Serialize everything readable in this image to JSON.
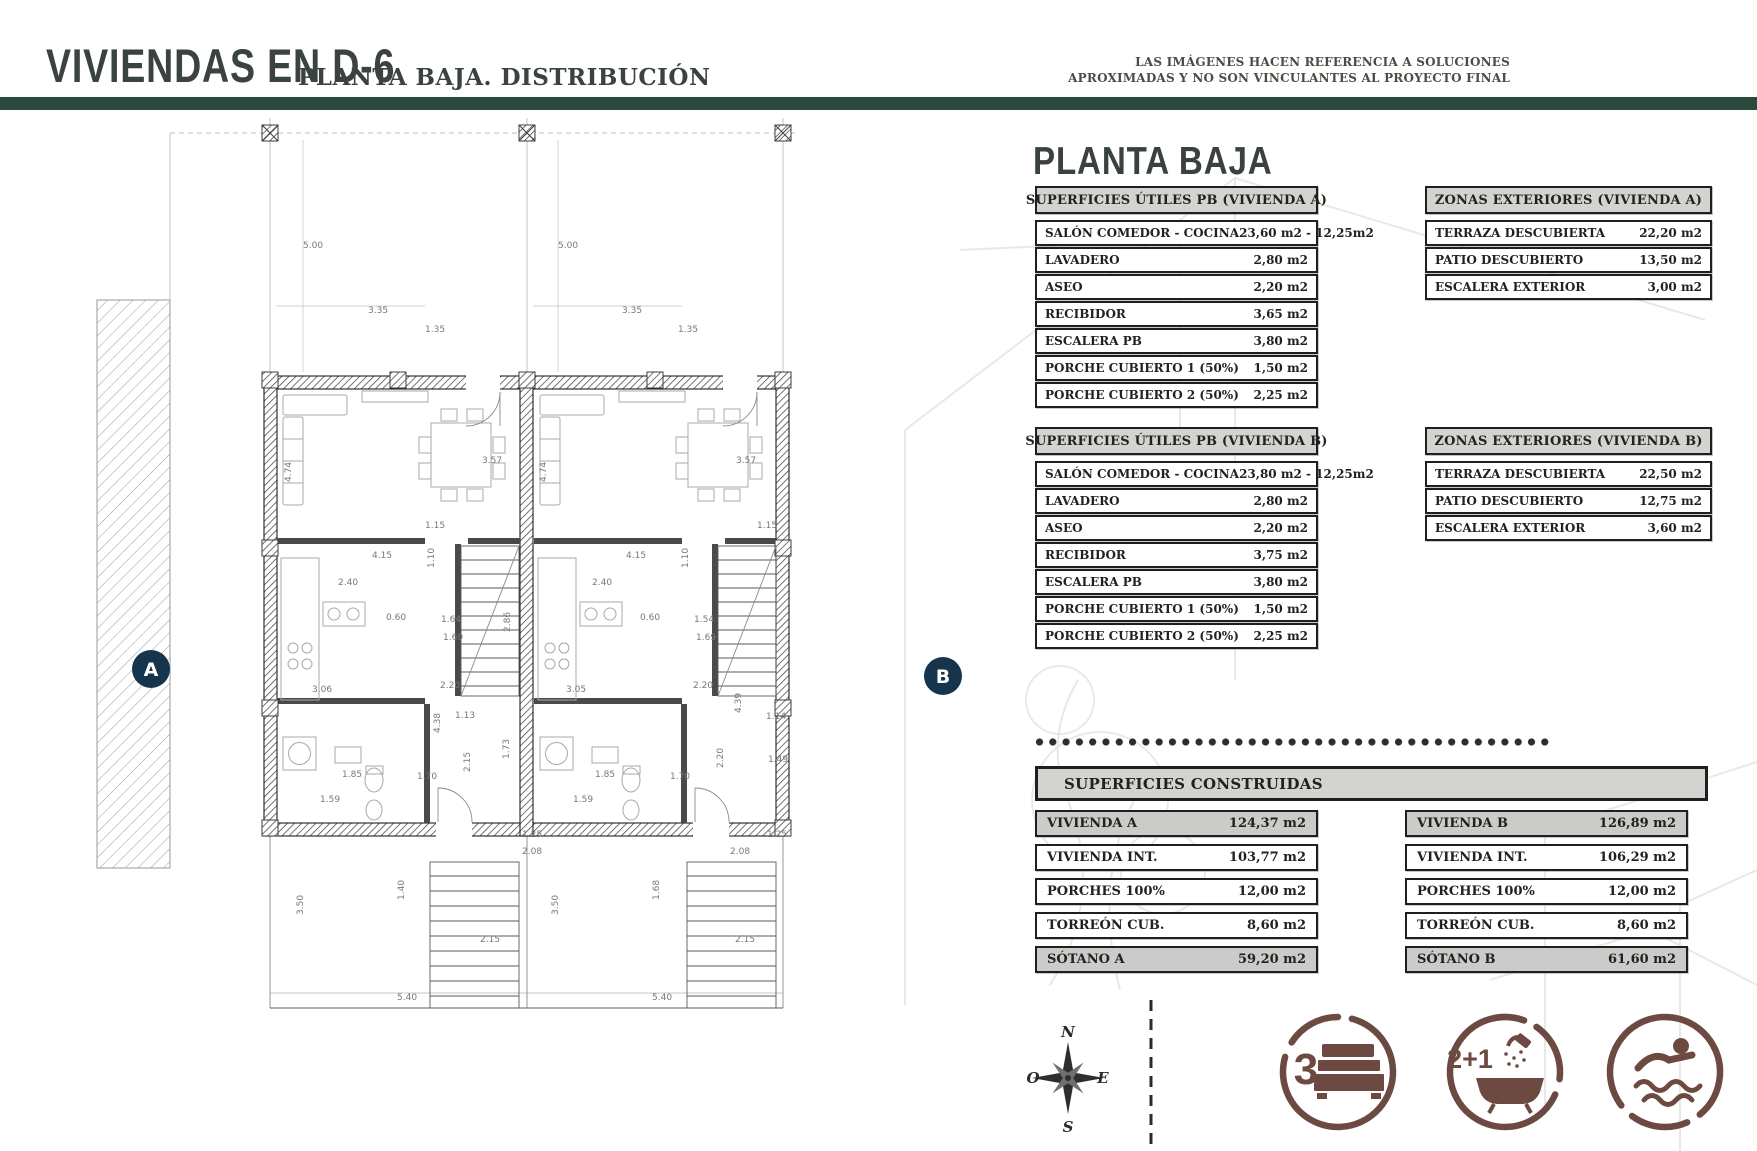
{
  "colors": {
    "accent_green": "#2a4a3e",
    "table_ink": "#1f1f1f",
    "table_header_gray": "#d3d3d0",
    "row_shaded_gray": "#cbcbc9",
    "icon_brown": "#6d4a41",
    "badge_navy": "#16354d"
  },
  "header": {
    "title": "VIVIENDAS EN D-6",
    "subtitle": "PLANTA BAJA. DISTRIBUCIÓN",
    "disclaimer": [
      "LAS IMÁGENES HACEN REFERENCIA A SOLUCIONES",
      "APROXIMADAS Y NO SON VINCULANTES AL PROYECTO FINAL"
    ]
  },
  "panel": {
    "heading": "PLANTA BAJA",
    "superficies_utiles_a": {
      "title": "SUPERFICIES ÚTILES PB (VIVIENDA A)",
      "rows": [
        {
          "label": "SALÓN COMEDOR - COCINA",
          "value": "23,60 m2 - 12,25m2"
        },
        {
          "label": "LAVADERO",
          "value": "2,80 m2"
        },
        {
          "label": "ASEO",
          "value": "2,20 m2"
        },
        {
          "label": "RECIBIDOR",
          "value": "3,65 m2"
        },
        {
          "label": "ESCALERA PB",
          "value": "3,80 m2"
        },
        {
          "label": "PORCHE CUBIERTO 1 (50%)",
          "value": "1,50 m2"
        },
        {
          "label": "PORCHE CUBIERTO 2 (50%)",
          "value": "2,25 m2"
        }
      ]
    },
    "zonas_exteriores_a": {
      "title": "ZONAS EXTERIORES (VIVIENDA A)",
      "rows": [
        {
          "label": "TERRAZA DESCUBIERTA",
          "value": "22,20 m2"
        },
        {
          "label": "PATIO DESCUBIERTO",
          "value": "13,50 m2"
        },
        {
          "label": "ESCALERA EXTERIOR",
          "value": "3,00 m2"
        }
      ]
    },
    "superficies_utiles_b": {
      "title": "SUPERFICIES ÚTILES PB (VIVIENDA B)",
      "rows": [
        {
          "label": "SALÓN COMEDOR - COCINA",
          "value": "23,80 m2 - 12,25m2"
        },
        {
          "label": "LAVADERO",
          "value": "2,80 m2"
        },
        {
          "label": "ASEO",
          "value": "2,20 m2"
        },
        {
          "label": "RECIBIDOR",
          "value": "3,75 m2"
        },
        {
          "label": "ESCALERA PB",
          "value": "3,80 m2"
        },
        {
          "label": "PORCHE CUBIERTO 1 (50%)",
          "value": "1,50 m2"
        },
        {
          "label": "PORCHE CUBIERTO 2 (50%)",
          "value": "2,25 m2"
        }
      ]
    },
    "zonas_exteriores_b": {
      "title": "ZONAS EXTERIORES (VIVIENDA B)",
      "rows": [
        {
          "label": "TERRAZA DESCUBIERTA",
          "value": "22,50 m2"
        },
        {
          "label": "PATIO DESCUBIERTO",
          "value": "12,75 m2"
        },
        {
          "label": "ESCALERA EXTERIOR",
          "value": "3,60 m2"
        }
      ]
    },
    "superficies_construidas": {
      "title": "SUPERFICIES CONSTRUIDAS",
      "columna_a": [
        {
          "label": "VIVIENDA A",
          "value": "124,37 m2",
          "shaded": true
        },
        {
          "label": "VIVIENDA INT.",
          "value": "103,77 m2"
        },
        {
          "label": "PORCHES 100%",
          "value": "12,00 m2"
        },
        {
          "label": "TORREÓN CUB.",
          "value": "8,60 m2"
        },
        {
          "label": "SÓTANO A",
          "value": "59,20 m2",
          "shaded": true
        }
      ],
      "columna_b": [
        {
          "label": "VIVIENDA B",
          "value": "126,89 m2",
          "shaded": true
        },
        {
          "label": "VIVIENDA INT.",
          "value": "106,29 m2"
        },
        {
          "label": "PORCHES 100%",
          "value": "12,00 m2"
        },
        {
          "label": "TORREÓN CUB.",
          "value": "8,60 m2"
        },
        {
          "label": "SÓTANO B",
          "value": "61,60 m2",
          "shaded": true
        }
      ]
    }
  },
  "features": {
    "bedrooms": "3",
    "bathrooms": "2+1"
  },
  "compass": {
    "north": "N",
    "east": "E",
    "south": "S",
    "west": "O"
  },
  "floor_plan": {
    "unit_a_label": "A",
    "unit_b_label": "B",
    "dimension_labels": [
      {
        "x": 303,
        "y": 248,
        "v": "5.00"
      },
      {
        "x": 558,
        "y": 248,
        "v": "5.00"
      },
      {
        "x": 368,
        "y": 313,
        "v": "3.35"
      },
      {
        "x": 425,
        "y": 332,
        "v": "1.35"
      },
      {
        "x": 622,
        "y": 313,
        "v": "3.35"
      },
      {
        "x": 678,
        "y": 332,
        "v": "1.35"
      },
      {
        "x": 291,
        "y": 482,
        "v": "4.74",
        "r": -90
      },
      {
        "x": 546,
        "y": 482,
        "v": "4.74",
        "r": -90
      },
      {
        "x": 482,
        "y": 463,
        "v": "3.57"
      },
      {
        "x": 736,
        "y": 463,
        "v": "3.57"
      },
      {
        "x": 425,
        "y": 528,
        "v": "1.15"
      },
      {
        "x": 757,
        "y": 528,
        "v": "1.15"
      },
      {
        "x": 372,
        "y": 558,
        "v": "4.15"
      },
      {
        "x": 626,
        "y": 558,
        "v": "4.15"
      },
      {
        "x": 338,
        "y": 585,
        "v": "2.40"
      },
      {
        "x": 592,
        "y": 585,
        "v": "2.40"
      },
      {
        "x": 434,
        "y": 568,
        "v": "1.10",
        "r": -90
      },
      {
        "x": 688,
        "y": 568,
        "v": "1.10",
        "r": -90
      },
      {
        "x": 386,
        "y": 620,
        "v": "0.60"
      },
      {
        "x": 640,
        "y": 620,
        "v": "0.60"
      },
      {
        "x": 441,
        "y": 622,
        "v": "1.64"
      },
      {
        "x": 694,
        "y": 622,
        "v": "1.54"
      },
      {
        "x": 443,
        "y": 640,
        "v": "1.69"
      },
      {
        "x": 696,
        "y": 640,
        "v": "1.69"
      },
      {
        "x": 510,
        "y": 632,
        "v": "2.86",
        "r": -90
      },
      {
        "x": 440,
        "y": 688,
        "v": "2.20"
      },
      {
        "x": 693,
        "y": 688,
        "v": "2.20"
      },
      {
        "x": 312,
        "y": 692,
        "v": "3.06"
      },
      {
        "x": 566,
        "y": 692,
        "v": "3.05"
      },
      {
        "x": 455,
        "y": 718,
        "v": "1.13"
      },
      {
        "x": 741,
        "y": 713,
        "v": "4.39",
        "r": -90
      },
      {
        "x": 440,
        "y": 733,
        "v": "4.38",
        "r": -90
      },
      {
        "x": 766,
        "y": 719,
        "v": "1.14"
      },
      {
        "x": 509,
        "y": 759,
        "v": "1.73",
        "r": -90
      },
      {
        "x": 342,
        "y": 777,
        "v": "1.85"
      },
      {
        "x": 595,
        "y": 777,
        "v": "1.85"
      },
      {
        "x": 417,
        "y": 779,
        "v": "1.70"
      },
      {
        "x": 670,
        "y": 779,
        "v": "1.70"
      },
      {
        "x": 470,
        "y": 772,
        "v": "2.15",
        "r": -90
      },
      {
        "x": 723,
        "y": 768,
        "v": "2.20",
        "r": -90
      },
      {
        "x": 768,
        "y": 762,
        "v": "1.49"
      },
      {
        "x": 320,
        "y": 802,
        "v": "1.59"
      },
      {
        "x": 573,
        "y": 802,
        "v": "1.59"
      },
      {
        "x": 522,
        "y": 837,
        "v": "1.25"
      },
      {
        "x": 767,
        "y": 837,
        "v": "1.25"
      },
      {
        "x": 522,
        "y": 854,
        "v": "2.08"
      },
      {
        "x": 730,
        "y": 854,
        "v": "2.08"
      },
      {
        "x": 303,
        "y": 915,
        "v": "3.50",
        "r": -90
      },
      {
        "x": 558,
        "y": 915,
        "v": "3.50",
        "r": -90
      },
      {
        "x": 404,
        "y": 900,
        "v": "1.40",
        "r": -90
      },
      {
        "x": 659,
        "y": 900,
        "v": "1.68",
        "r": -90
      },
      {
        "x": 480,
        "y": 942,
        "v": "2.15"
      },
      {
        "x": 735,
        "y": 942,
        "v": "2.15"
      },
      {
        "x": 397,
        "y": 1000,
        "v": "5.40"
      },
      {
        "x": 652,
        "y": 1000,
        "v": "5.40"
      }
    ]
  }
}
